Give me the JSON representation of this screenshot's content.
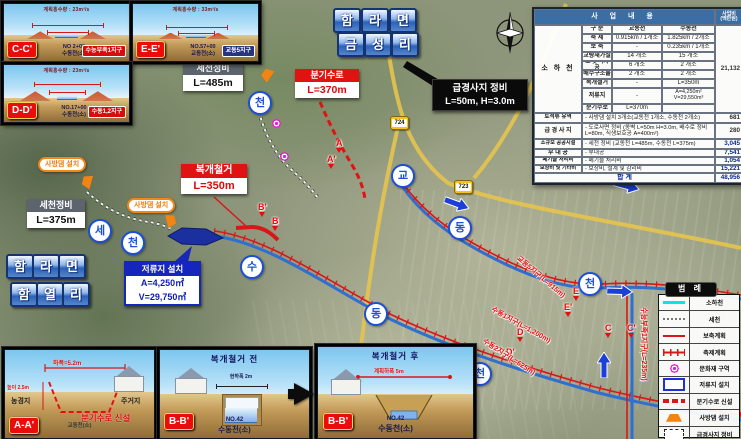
{
  "top_title": {
    "line1": [
      "함",
      "라",
      "면"
    ],
    "line2": [
      "금",
      "성",
      "리"
    ]
  },
  "left_title": {
    "line1": [
      "함",
      "라",
      "면"
    ],
    "line2": [
      "함",
      "열",
      "리"
    ]
  },
  "insets_top": [
    {
      "badge": "C-C'",
      "flow": "계획홍수량 : 23m³/s",
      "station": "NO 2+00",
      "stream": "수동천(소)",
      "district": "수능부족1지구"
    },
    {
      "badge": "E-E'",
      "flow": "계획홍수량 : 33m³/s",
      "station": "NO.57+00",
      "stream": "교동천(소)",
      "district": "교동5지구"
    },
    {
      "badge": "D-D'",
      "flow": "계획홍수량 : 23m³/s",
      "station": "NO.17+00",
      "stream": "수동천(소)",
      "district": "수동1,2지구"
    }
  ],
  "sections_bottom": {
    "a": {
      "badge": "A-A'",
      "width_dim": "하폭=5.2m",
      "height_dim": "높이 2.5m",
      "left_label": "농경지",
      "right_label": "주거지",
      "stream": "교동천(소)",
      "note": "분기수로 신설"
    },
    "b1": {
      "badge": "B-B'",
      "title": "복개철거 전",
      "dim": "현하폭 2m",
      "station": "NO.42",
      "stream": "수동천(소)"
    },
    "b2": {
      "badge": "B-B'",
      "title": "복개철거 후",
      "dim": "계획하폭 5m",
      "station": "NO.42",
      "stream": "수동천(소)"
    }
  },
  "callouts": {
    "secheon485": {
      "title": "세천정비",
      "value": "L=485m"
    },
    "bungisuro": {
      "title": "분기수로",
      "value": "L=370m"
    },
    "slope": {
      "line1": "급경사지 정비",
      "line2": "L=50m, H=3.0m"
    },
    "bokgae": {
      "title": "복개철거",
      "value": "L=350m"
    },
    "secheon375": {
      "title": "세천정비",
      "value": "L=375m"
    },
    "jeoryuji": {
      "title": "저류지 설치",
      "area": "A=4,250㎡",
      "volume": "V=29,750㎥"
    },
    "sabang1": "사방댐 설치",
    "sabang2": "사방댐 설치"
  },
  "route_badges": [
    "724",
    "723"
  ],
  "stream_circles": [
    {
      "ch": "천"
    },
    {
      "ch": "세"
    },
    {
      "ch": "천"
    },
    {
      "ch": "수"
    },
    {
      "ch": "동"
    },
    {
      "ch": "천"
    },
    {
      "ch": "교"
    },
    {
      "ch": "동"
    },
    {
      "ch": "천"
    }
  ],
  "section_markers": [
    {
      "t": "A"
    },
    {
      "t": "A'"
    },
    {
      "t": "B'"
    },
    {
      "t": "B"
    },
    {
      "t": "E"
    },
    {
      "t": "E'"
    },
    {
      "t": "D"
    },
    {
      "t": "D'"
    },
    {
      "t": "C"
    },
    {
      "t": "C'"
    }
  ],
  "district_labels": [
    {
      "text": "교동5지구(L=915m)"
    },
    {
      "text": "수동1지구(L=1,200m)"
    },
    {
      "text": "수동2지구(L=625m)"
    },
    {
      "text": "수능부족1지구(L=235m)"
    }
  ],
  "table": {
    "title": "사 업 내 용",
    "cost_header1": "사업비",
    "cost_header2": "(백만원)",
    "category": "소 하 천",
    "category_cost": "21,132",
    "sub_rows": [
      {
        "l": "구 분",
        "g": "교동천",
        "s": "수동천"
      },
      {
        "l": "축 제",
        "g": "0.915km / 1개소",
        "s": "1.825km / 2개소"
      },
      {
        "l": "보 축",
        "g": "-",
        "s": "0.235km / 1개소"
      },
      {
        "l": "교량재가설",
        "g": "14 개소",
        "s": "15 개소"
      },
      {
        "l": "보 및 낙차공",
        "g": "6 개소",
        "s": "2 개소"
      },
      {
        "l": "배수구조물",
        "g": "2 개소",
        "s": "2 개소"
      },
      {
        "l": "복개철거",
        "g": "-",
        "s": "L=350m"
      },
      {
        "l": "저류지",
        "g": "-",
        "s": "A=4,250m² V=29,550m³"
      },
      {
        "l": "분기수로",
        "g": "L=370m",
        "s": ""
      }
    ],
    "wide_rows": [
      {
        "label": "토석류 유역",
        "desc": "- 사방댐 설치 3개소(교동천 1개소, 수동천 2개소)",
        "cost": "681"
      },
      {
        "label": "급 경 사 지",
        "desc": "- 도로사면 정비 (옹벽 L=50m H=3.0m, 배수로 정비 L=80m, 식생보호공 A=400m²)",
        "cost": "280"
      },
      {
        "label": "소규모 공공시설",
        "desc": "- 세천 정비 (교동천 L=485m, 수동천 L=375m)",
        "cost": "3,045"
      },
      {
        "label": "부 대 공",
        "desc": "- 부대공",
        "cost": "7,541"
      },
      {
        "label": "폐기물 처리비",
        "desc": "- 폐기물 처리비",
        "cost": "1,054"
      },
      {
        "label": "보상비 및 기타비",
        "desc": "- 보상비, 설계 및 감리비",
        "cost": "15,221"
      }
    ],
    "total_label": "합              계",
    "total": "48,956"
  },
  "legend": {
    "title": "범 례",
    "items": [
      {
        "label": "소하천"
      },
      {
        "label": "세천"
      },
      {
        "label": "보축계획"
      },
      {
        "label": "축제계획"
      },
      {
        "label": "문화재 구역"
      },
      {
        "label": "저류지 설치"
      },
      {
        "label": "분기수로 신설"
      },
      {
        "label": "사방댐 설치"
      },
      {
        "label": "급경사지 정비"
      }
    ]
  },
  "colors": {
    "accent_red": "#e01212",
    "accent_blue": "#1b4fd8",
    "jeoryuji_blue": "#1626bc",
    "legend_cyan": "#0ce4e4",
    "sabang_orange": "#f28414"
  }
}
